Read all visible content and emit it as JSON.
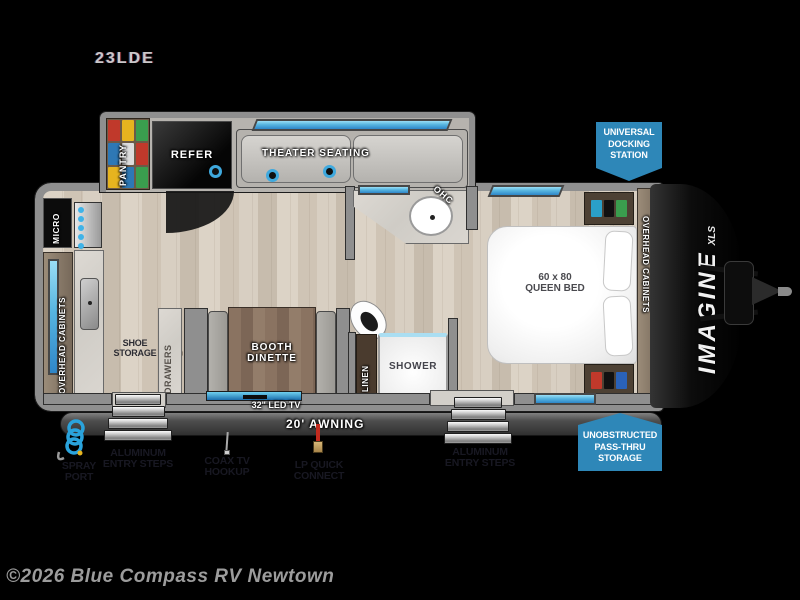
{
  "model": "23LDE",
  "copyright": "©2026 Blue Compass RV Newtown",
  "brand": {
    "name": "IMAGINE",
    "sub": "XLS"
  },
  "callouts": {
    "docking": [
      "UNIVERSAL",
      "DOCKING",
      "STATION"
    ],
    "passthru": [
      "UNOBSTRUCTED",
      "PASS-THRU",
      "STORAGE"
    ]
  },
  "rooms": {
    "pantry": "PANTRY",
    "refer": "REFER",
    "theater": "THEATER SEATING",
    "micro": "MICRO",
    "overhead_left": "OVERHEAD CABINETS",
    "overhead_right": "OVERHEAD CABINETS",
    "ohc": "OHC",
    "shoe": [
      "SHOE",
      "STORAGE"
    ],
    "drawers": "DRAWERS",
    "booth": [
      "BOOTH",
      "DINETTE"
    ],
    "linen": "LINEN",
    "shower": "SHOWER",
    "bed": [
      "60 x 80",
      "QUEEN BED"
    ]
  },
  "features": {
    "tv": "32\" LED TV",
    "awning": "20' AWNING"
  },
  "annotations": {
    "spray": [
      "SPRAY",
      "PORT"
    ],
    "steps_left": [
      "ALUMINUM",
      "ENTRY STEPS"
    ],
    "coax": [
      "COAX TV",
      "HOOKUP"
    ],
    "lp": [
      "LP QUICK",
      "CONNECT"
    ],
    "steps_right": [
      "ALUMINUM",
      "ENTRY STEPS"
    ]
  },
  "colors": {
    "callout_blue": "#2e87b8",
    "window_blue": "#57b5e0",
    "accent_black": "#000000"
  }
}
